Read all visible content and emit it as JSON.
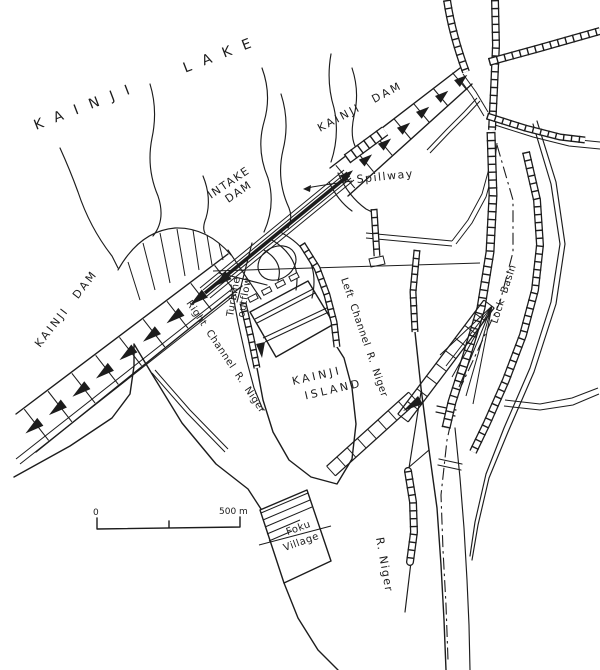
{
  "labels": {
    "lake": "KAINJI LAKE",
    "dam_west": "KAINJI DAM",
    "dam_east": "KAINJI DAM",
    "intake": {
      "line1": "INTAKE",
      "line2": "DAM"
    },
    "spillway": "Spillway",
    "turbine": {
      "line1": "Turbine",
      "line2": "outflow"
    },
    "right_channel": "Right Channel R. Niger",
    "left_channel": "Left Channel R. Niger",
    "island": {
      "line1": "KAINJI",
      "line2": "ISLAND"
    },
    "lock_basin": "Lock Basin",
    "river": "R. Niger",
    "village": {
      "line1": "Foku",
      "line2": "Village"
    },
    "scale": {
      "zero": "0",
      "max": "500 m"
    }
  },
  "colors": {
    "ink": "#1c1c1c",
    "paper": "#ffffff"
  }
}
